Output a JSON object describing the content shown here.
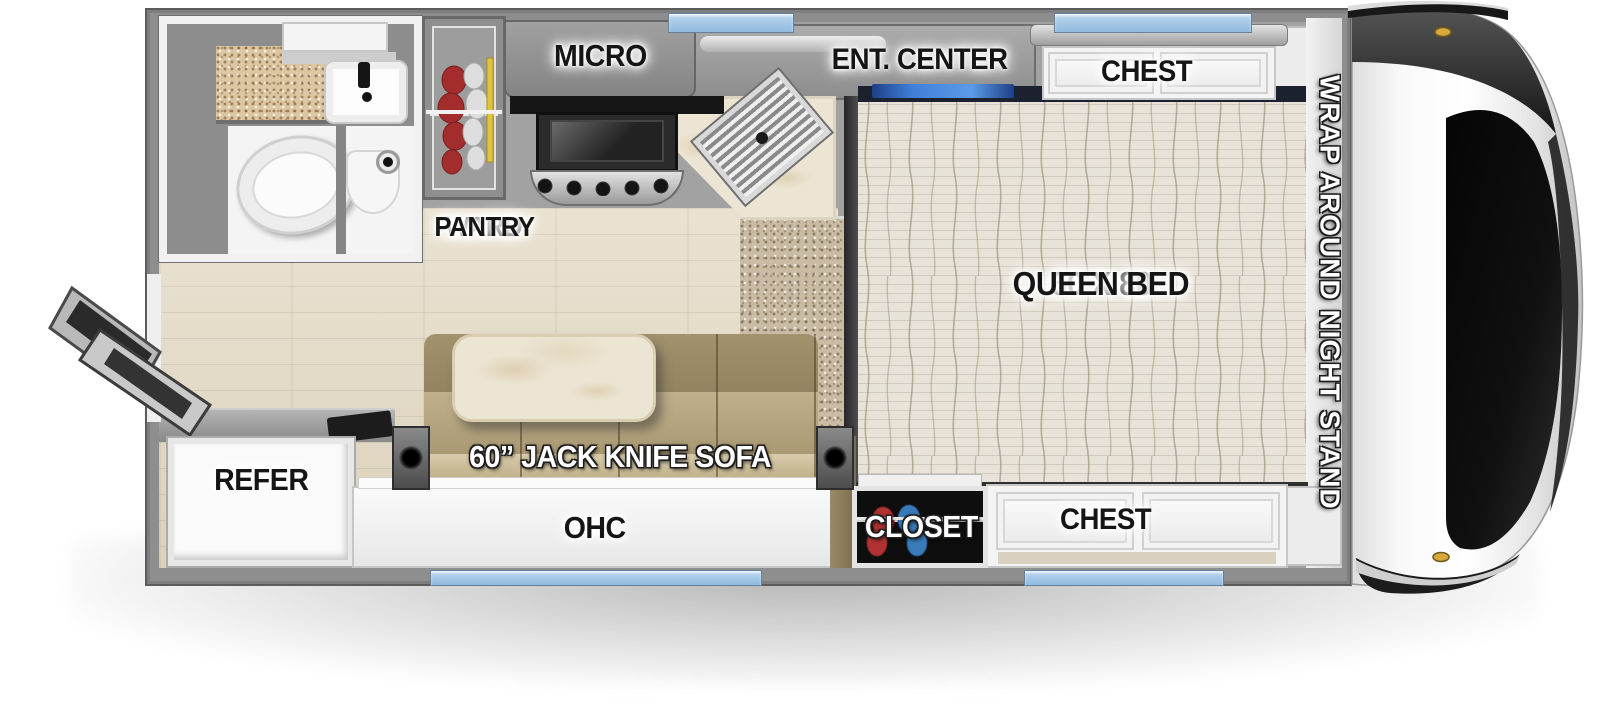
{
  "title": "Truck camper floor plan",
  "labels": {
    "micro": "MICRO",
    "ent_center": "ENT. CENTER",
    "chest_top": "CHEST",
    "ward_line1": "WARD",
    "ward_line2": "PANTRY",
    "bed_size": "60 X 80",
    "bed_type": "QUEEN BED",
    "night_stand": "WRAP AROUND NIGHT STAND",
    "refer": "REFER",
    "sofa": "60” JACK KNIFE SOFA",
    "ohc": "OHC",
    "closet": "CLOSET",
    "chest_bottom": "CHEST"
  },
  "colors": {
    "wall": "#8e8e8e",
    "window_blue": "#a7cdec",
    "led_blue": "#3f7fd9",
    "label_dark": "#151515",
    "label_light": "#ffffff",
    "bed": "#e7e2d6",
    "carpet": "#c9bba4",
    "wood_floor": "#e3dac8",
    "sofa_tan": "#b2a27e",
    "counter_marble": "#ece5d4",
    "clothes_red": "#a83030",
    "clothes_blue": "#3a7ab8",
    "hanger_yellow": "#e2c43c"
  }
}
